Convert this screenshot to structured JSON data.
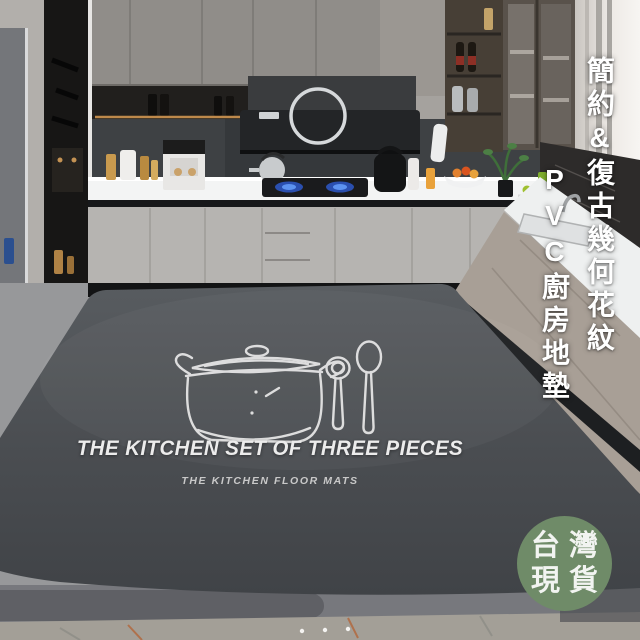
{
  "product_overlays": {
    "vertical_headline": "簡約&復古幾何花紋",
    "vertical_subline": "PVC廚房地墊",
    "stock_badge": {
      "line1": "台灣",
      "line2": "現貨",
      "bg_color": "#6f8b68",
      "text_color": "#f2f4f1"
    }
  },
  "mat_print": {
    "title": "THE KITCHEN SET OF THREE PIECES",
    "subtitle": "THE KITCHEN FLOOR MATS",
    "illustration": "pot-with-lid-and-two-spoons",
    "mat_color": "#4b4e52"
  },
  "scene": {
    "type": "kitchen-photo",
    "colors": {
      "upper_cabinets": "#908d89",
      "base_cabinets": "#b6b4b1",
      "right_cabinets": "#a89f96",
      "countertop": "#f3f4f4",
      "backsplash": "#3e4144",
      "floor": "#97989a",
      "floor_band": "#77787d",
      "marble_floor": "#a39f97",
      "flame_blue": "#3f6fd8",
      "led_glow": "#cf9550"
    }
  }
}
